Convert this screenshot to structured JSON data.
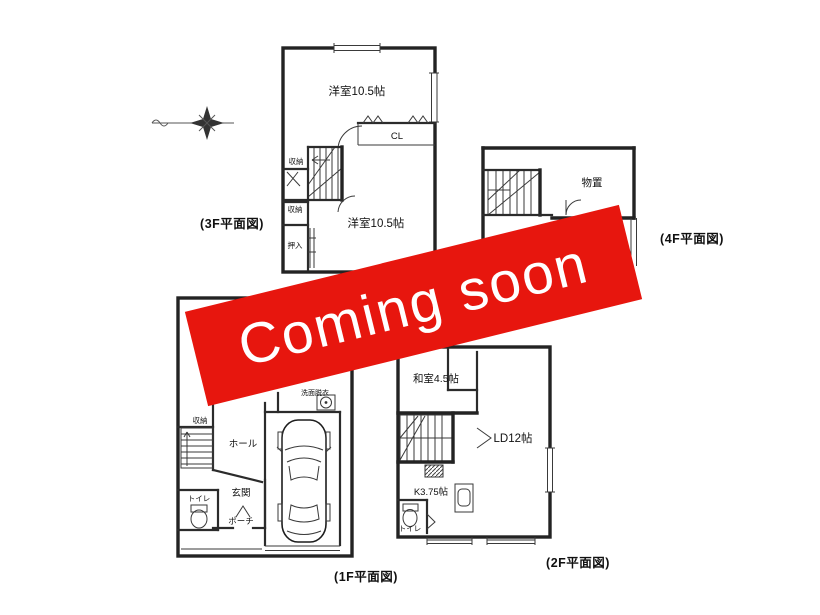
{
  "banner": {
    "label": "Coming soon",
    "background": "#e7160e",
    "text_color": "#ffffff"
  },
  "ink_color": "#232323",
  "compass": {
    "icon": "compass-north-star"
  },
  "plans": {
    "f3": {
      "caption": "(3F平面図)",
      "labels": {
        "room_upper": "洋室10.5帖",
        "closet_cl": "CL",
        "storage_a": "収納",
        "storage_b": "収納",
        "oshiire": "押入",
        "room_lower": "洋室10.5帖"
      }
    },
    "f4": {
      "caption": "(4F平面図)",
      "labels": {
        "storeroom": "物置"
      }
    },
    "f1": {
      "caption": "(1F平面図)",
      "labels": {
        "washroom": "洗面脱衣",
        "storage": "収納",
        "hall": "ホール",
        "entrance": "玄関",
        "toilet": "トイレ",
        "porch": "ポーチ"
      }
    },
    "f2": {
      "caption": "(2F平面図)",
      "labels": {
        "japanese_room": "和室4.5帖",
        "living_dining": "LD12帖",
        "kitchen": "K3.75帖",
        "toilet": "トイレ"
      }
    }
  }
}
